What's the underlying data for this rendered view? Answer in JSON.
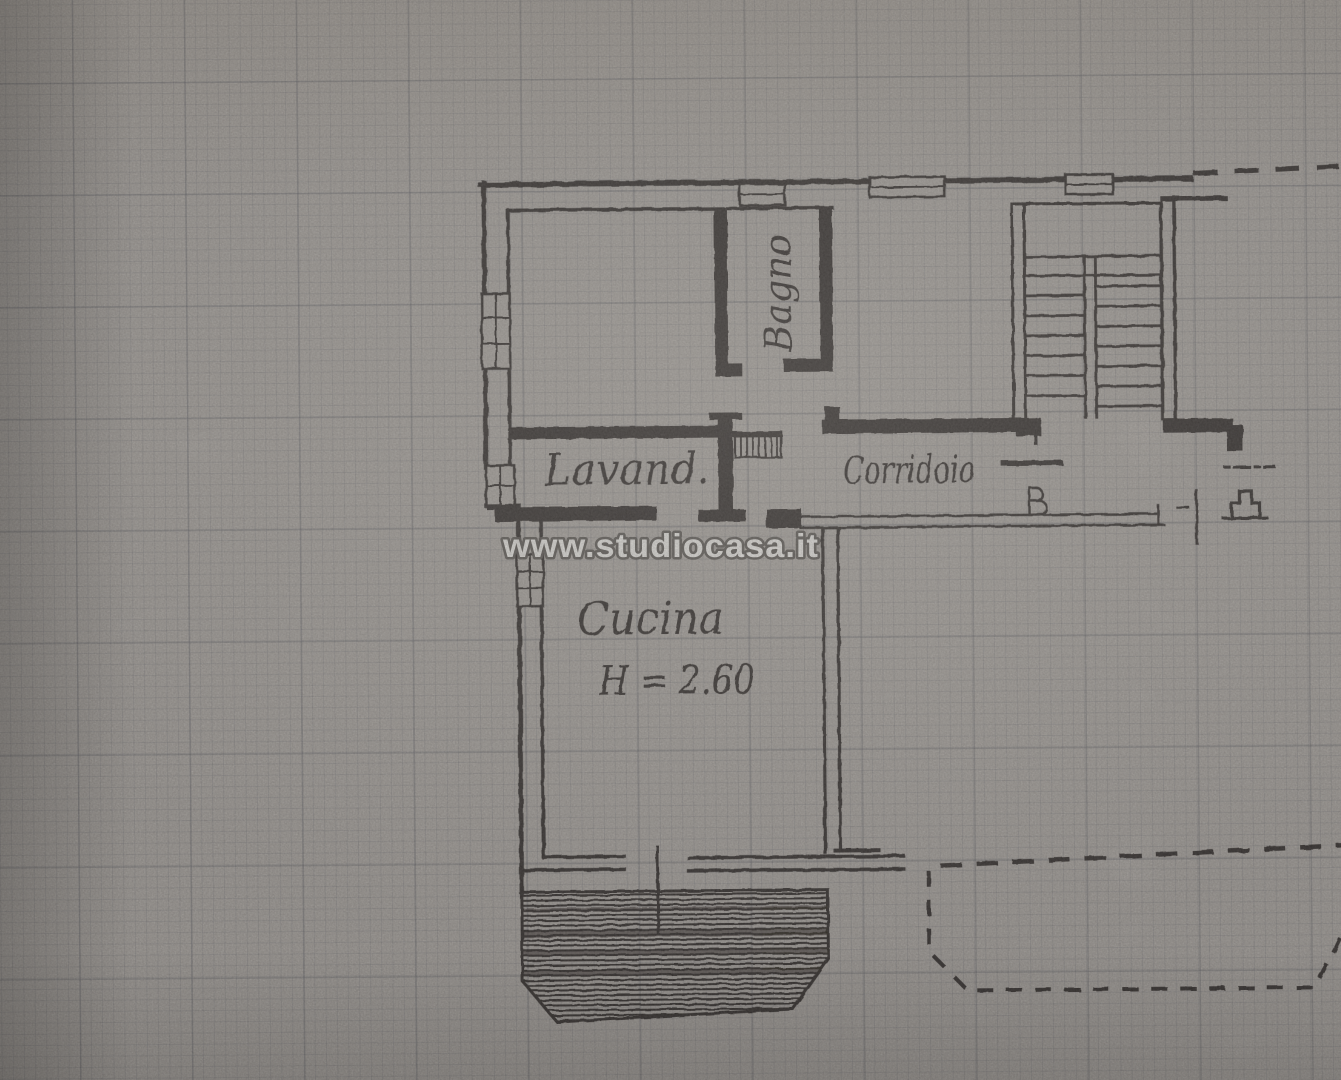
{
  "scene": {
    "description": "Photographed hand-drawn apartment floor plan in black ink on gray graph paper",
    "icons": {
      "staircase": "double-flight stair with treads, top right",
      "radiator": "small hatched rectangle on corridor wall",
      "balcony": "hatched trapezoid at bottom",
      "dashed-outline": "dashed neighbouring balcony outline, bottom right"
    }
  },
  "watermark": {
    "text": "www.studiocasa.it"
  },
  "labels": {
    "bathroom": "Bagno",
    "laundry": "Lavand.",
    "corridor": "Corridoio",
    "kitchen": "Cucina",
    "kitchen_height": "H = 2.60"
  },
  "colors": {
    "ink": "#262220",
    "paper": "#a9a5a1",
    "watermark_fill": "#f4f3f1",
    "watermark_outline": "#504d4a"
  }
}
